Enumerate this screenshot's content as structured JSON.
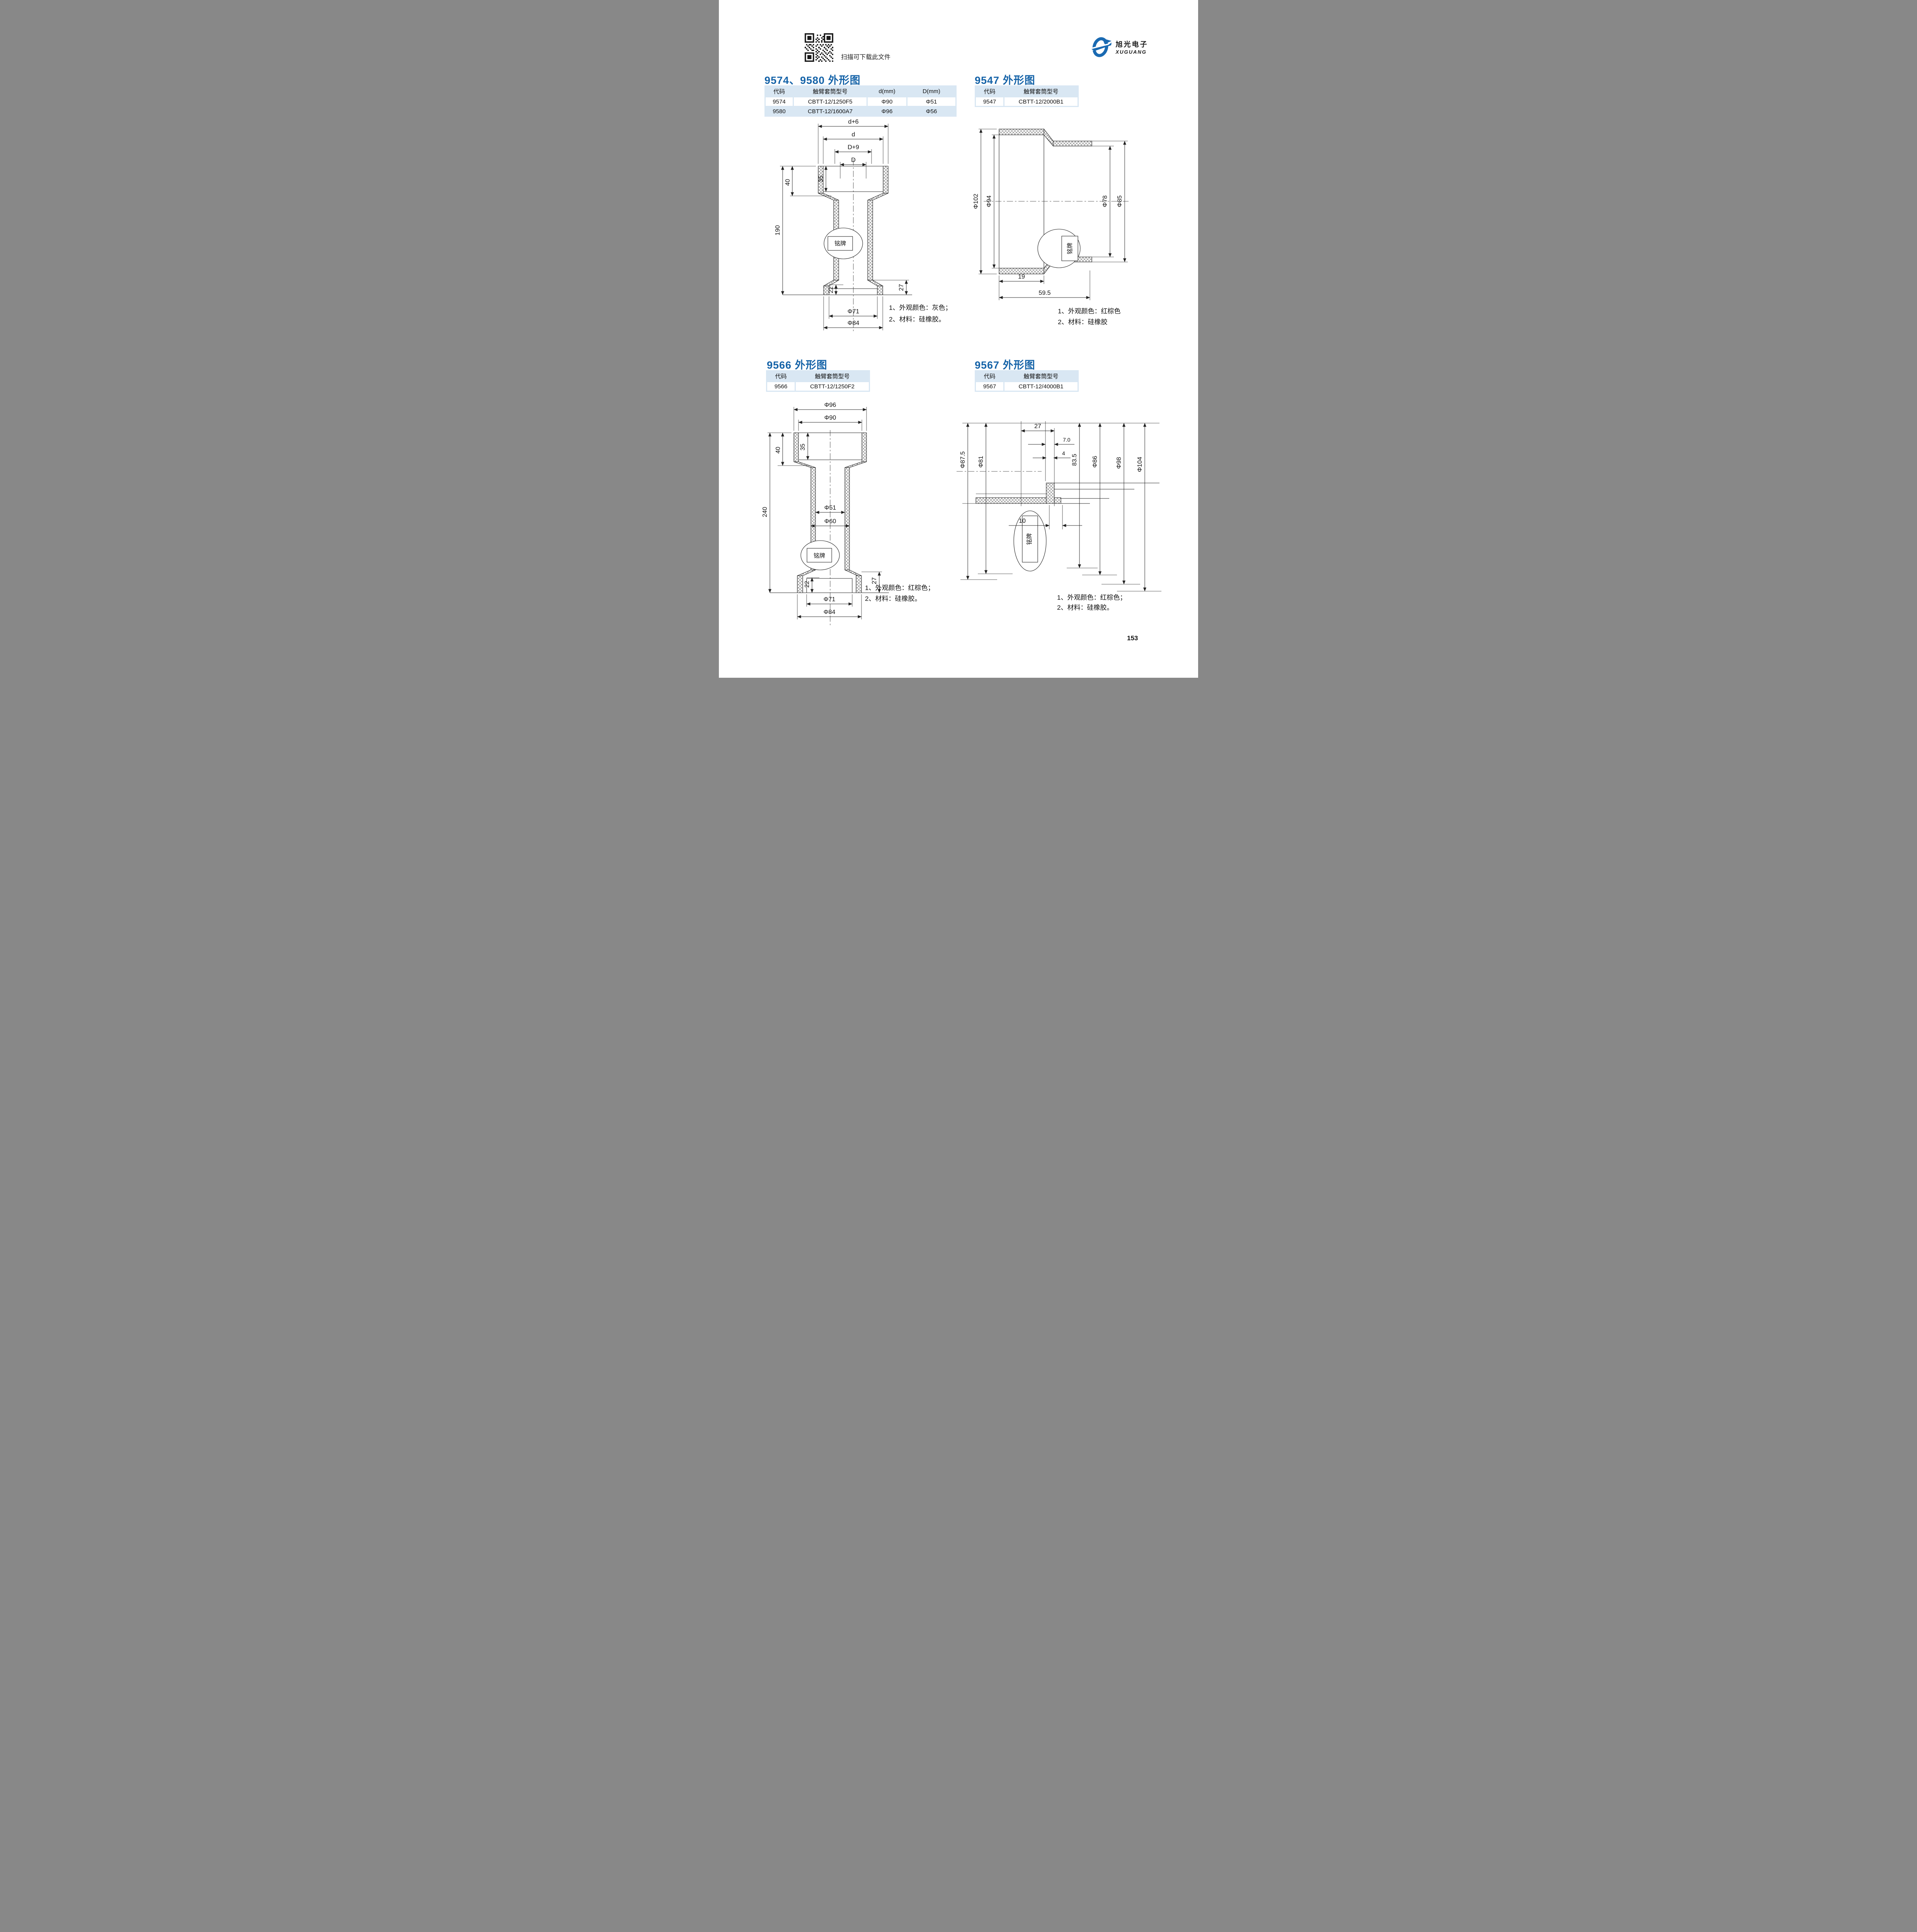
{
  "header": {
    "scan_hint": "扫描可下载此文件",
    "logo_cn": "旭光电子",
    "logo_en": "XUGUANG"
  },
  "footer": {
    "page_number": "153"
  },
  "colors": {
    "accent_blue": "#1563a8",
    "table_bg": "#d9e7f3",
    "logo_blue": "#1a6ab2"
  },
  "sections": [
    {
      "title": "9574、9580 外形图",
      "table": {
        "headers": [
          "代码",
          "触臂套筒型号",
          "d(mm)",
          "D(mm)"
        ],
        "rows": [
          [
            "9574",
            "CBTT-12/1250F5",
            "Φ90",
            "Φ51"
          ],
          [
            "9580",
            "CBTT-12/1600A7",
            "Φ96",
            "Φ56"
          ]
        ]
      },
      "drawing": {
        "dims": {
          "top1": "d+6",
          "top2": "d",
          "top3": "D+9",
          "top4": "D",
          "h40": "40",
          "h35": "35",
          "total": "190",
          "b22": "22",
          "b27": "27",
          "dia71": "Φ71",
          "dia84": "Φ84"
        },
        "nameplate": "铭牌",
        "notes": [
          "1、外观颜色：灰色；",
          "2、材料：硅橡胶。"
        ]
      }
    },
    {
      "title": "9547 外形图",
      "table": {
        "headers": [
          "代码",
          "触臂套筒型号"
        ],
        "rows": [
          [
            "9547",
            "CBTT-12/2000B1"
          ]
        ]
      },
      "drawing": {
        "dims": {
          "dia102": "Φ102",
          "dia94": "Φ94",
          "dia78": "Φ78",
          "dia85": "Φ85",
          "w19": "19",
          "w595": "59.5"
        },
        "nameplate": "铭牌",
        "notes": [
          "1、外观颜色：红棕色",
          "2、材料：硅橡胶"
        ]
      }
    },
    {
      "title": "9566 外形图",
      "table": {
        "headers": [
          "代码",
          "触臂套筒型号"
        ],
        "rows": [
          [
            "9566",
            "CBTT-12/1250F2"
          ]
        ]
      },
      "drawing": {
        "dims": {
          "dia96": "Φ96",
          "dia90": "Φ90",
          "h40": "40",
          "h35": "35",
          "total": "240",
          "dia51": "Φ51",
          "dia60": "Φ60",
          "b22": "22",
          "b27": "27",
          "dia71": "Φ71",
          "dia84": "Φ84"
        },
        "nameplate": "铭牌",
        "notes": [
          "1、外观颜色：红棕色；",
          "2、材料：硅橡胶。"
        ]
      }
    },
    {
      "title": "9567 外形图",
      "table": {
        "headers": [
          "代码",
          "触臂套筒型号"
        ],
        "rows": [
          [
            "9567",
            "CBTT-12/4000B1"
          ]
        ]
      },
      "drawing": {
        "dims": {
          "w27": "27",
          "w7": "7.0",
          "w4": "4",
          "w10": "10",
          "dia875": "Φ87.5",
          "dia81": "Φ81",
          "h835": "83.5",
          "dia86": "Φ86",
          "dia98": "Φ98",
          "dia104": "Φ104"
        },
        "nameplate": "铭牌",
        "notes": [
          "1、外观颜色：红棕色；",
          "2、材料：硅橡胶。"
        ]
      }
    }
  ]
}
